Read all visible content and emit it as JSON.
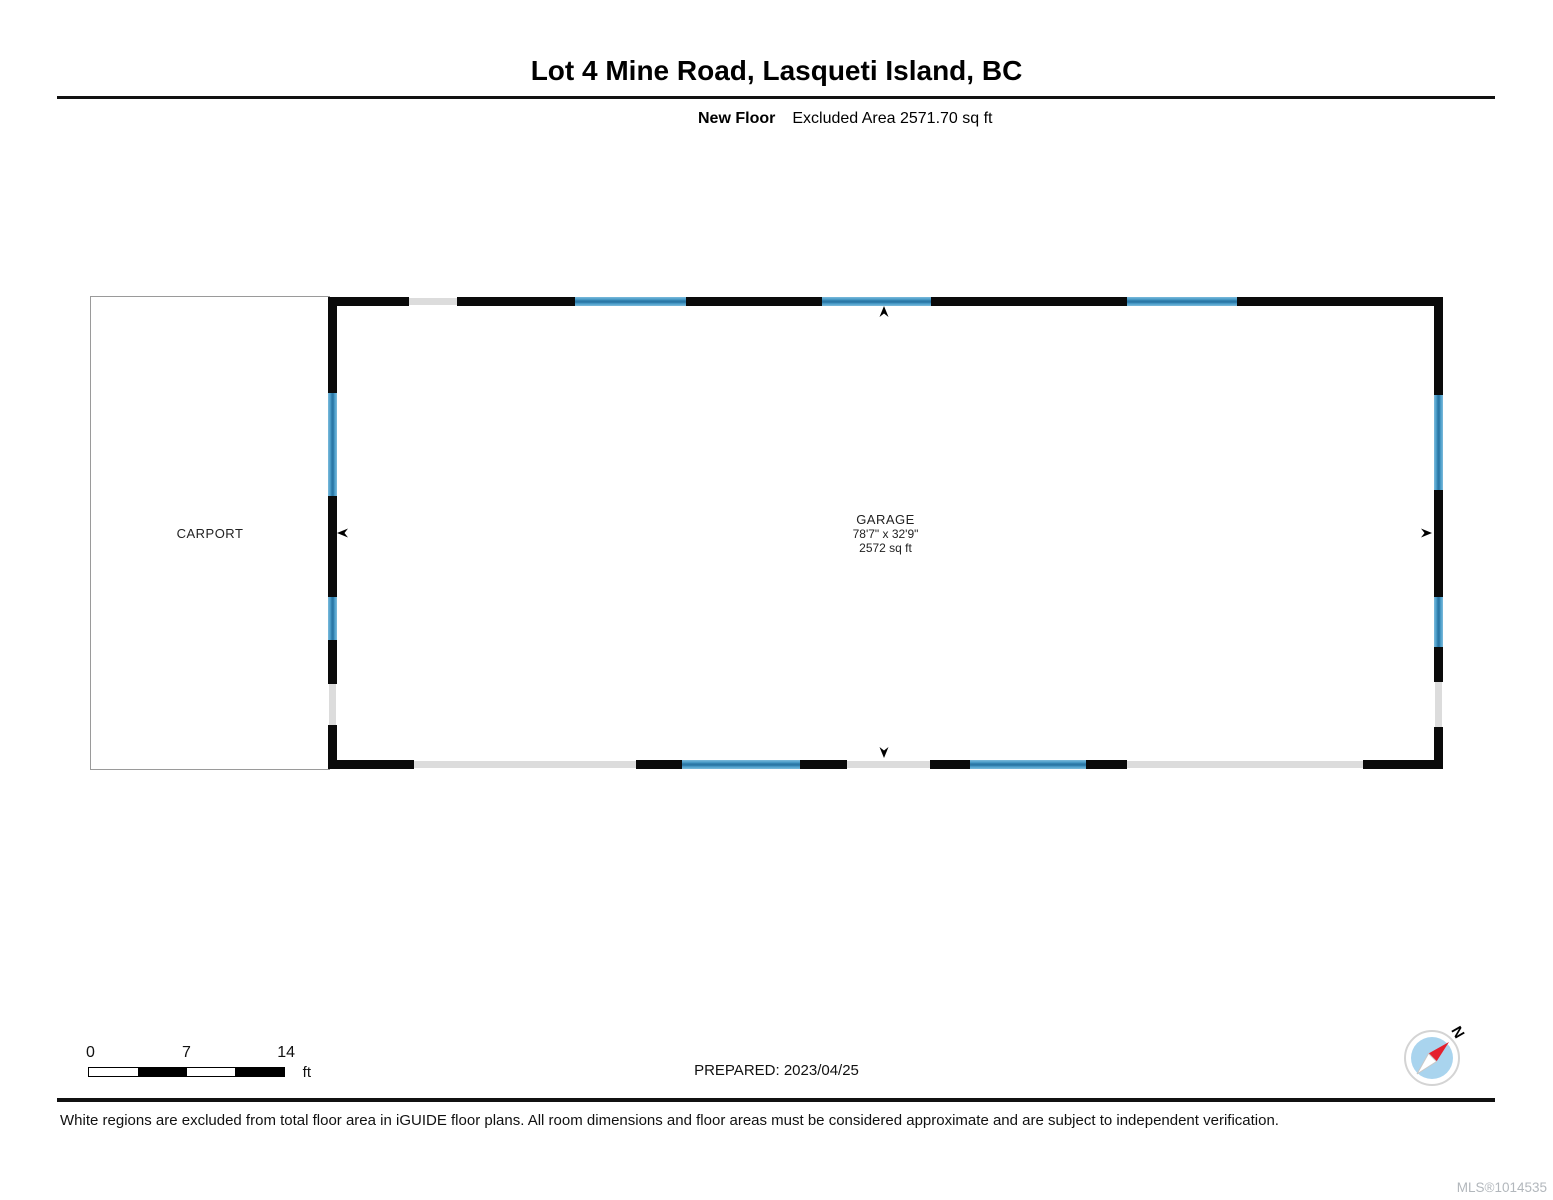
{
  "header": {
    "title": "Lot 4 Mine Road, Lasqueti Island, BC",
    "floor_name": "New Floor",
    "excluded_area": "Excluded Area 2571.70 sq ft"
  },
  "plan": {
    "carport": {
      "name": "CARPORT"
    },
    "garage": {
      "name": "GARAGE",
      "dimensions": "78'7\" x 32'9\"",
      "area": "2572 sq ft"
    },
    "colors": {
      "wall": "#0a0a0a",
      "window": "#4a9cc8",
      "opening": "#dcdcdc"
    }
  },
  "footer": {
    "scale_bar": {
      "ticks": [
        "0",
        "7",
        "14"
      ],
      "unit": "ft"
    },
    "prepared": "PREPARED: 2023/04/25",
    "compass_label": "N",
    "disclaimer": "White regions are excluded from total floor area in iGUIDE floor plans. All room dimensions and floor areas must be considered approximate and are subject to independent verification.",
    "mls": "MLS®1014535"
  }
}
